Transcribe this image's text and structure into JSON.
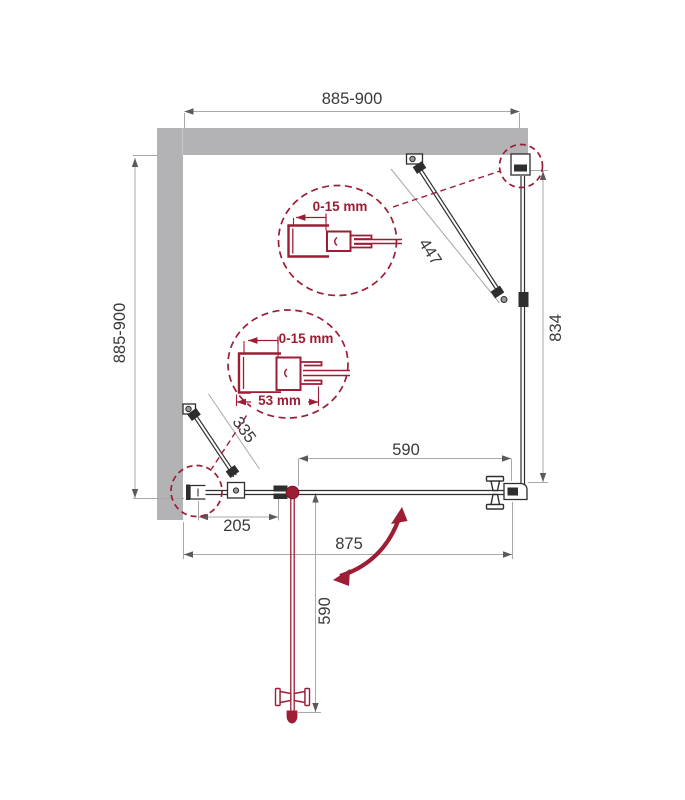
{
  "title": "Shower enclosure installation drawing (top view)",
  "colors": {
    "accent_crimson": "#9d1d35",
    "wall_grey": "#b3b3b6",
    "line_dark": "#2e2e2e",
    "dim_grey": "#a8a8a8",
    "text": "#3a3a3a"
  },
  "dimensions": {
    "top_width": "885-900",
    "left_depth": "885-900",
    "right_panel": "834",
    "right_support_bar": "447",
    "left_support_bar": "335",
    "door_width": "590",
    "left_fixed_panel": "205",
    "bottom_width": "875",
    "door_open_depth": "590"
  },
  "details": {
    "upper_profile_adjustment": "0-15 mm",
    "lower_profile_adjustment": "0-15 mm",
    "lower_profile_width": "53 mm"
  }
}
